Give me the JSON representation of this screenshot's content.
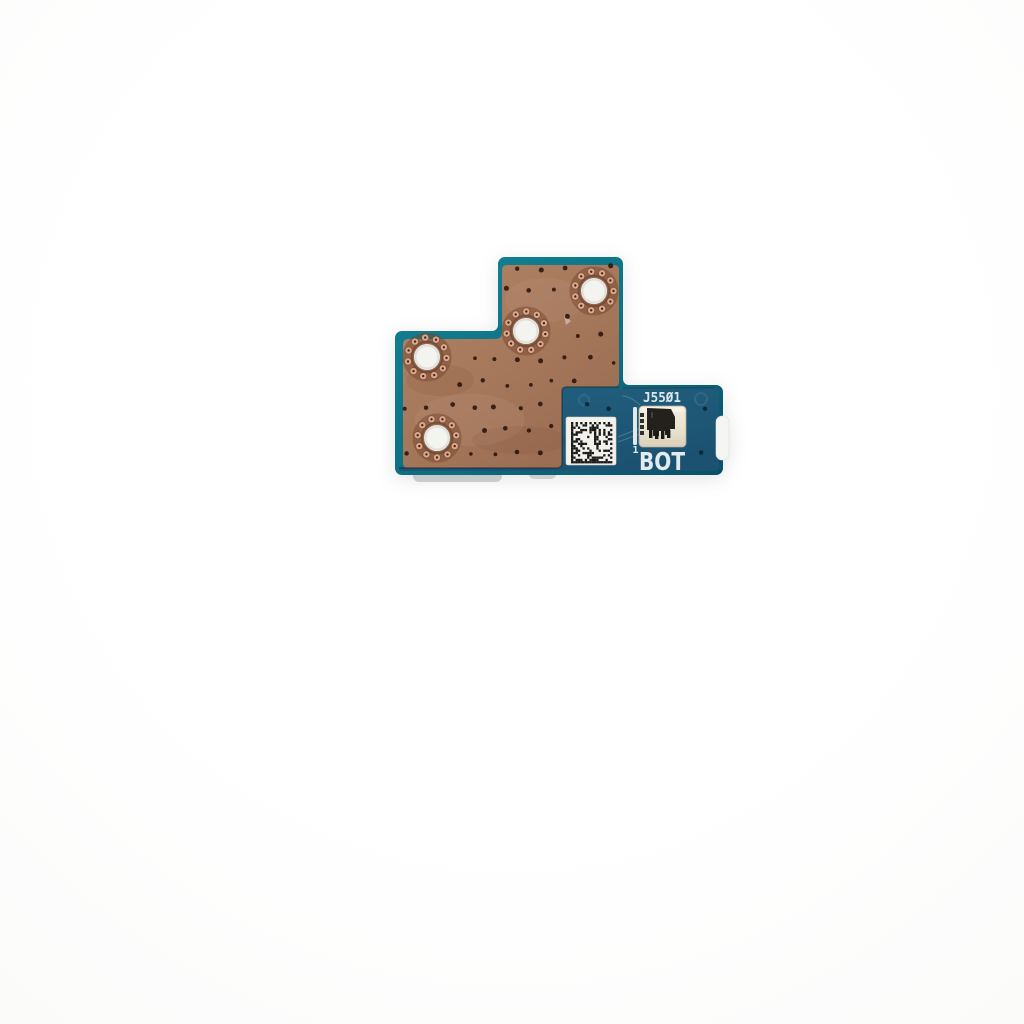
{
  "photo": {
    "subject": "Small laptop button circuit board photographed on a white background, bottom side up",
    "background_color": "#ffffff"
  },
  "board": {
    "silkscreen": {
      "connector_designator": "J55Ø1",
      "side_label": "BOT",
      "pin1_marker": "1"
    },
    "features": {
      "mounting_hole_count": 4,
      "barcode": "Data Matrix 2D barcode label",
      "connector_type": "FFC/FPC ribbon connector"
    },
    "colors": {
      "edge_teal": "#127F90",
      "solder_mask_blue": "#205C7A",
      "copper_plane": "#A87A5F",
      "silkscreen_white": "#E3ECEE",
      "hole_plating": "#F3F3EF"
    }
  }
}
